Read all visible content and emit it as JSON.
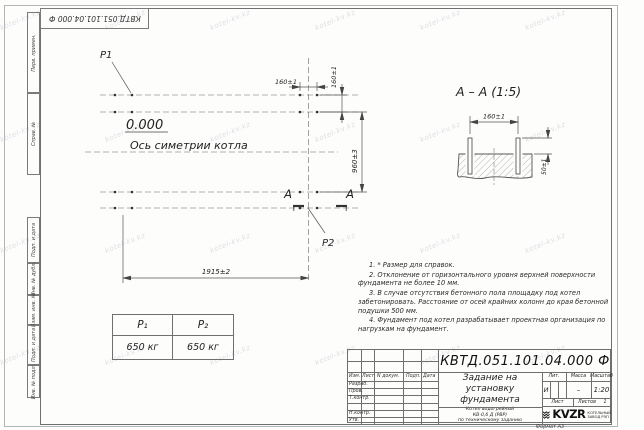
{
  "sheet": {
    "doc_number": "КВТД.051.101.04.000 Ф",
    "format_label": "Формат А3",
    "watermark": "kotel-kv.kz"
  },
  "margin": {
    "perv": "Перв. примен.",
    "sprav": "Справ. №",
    "podp1": "Подп. и дата",
    "inv_dubl": "Инв. № дубл.",
    "vzam": "Взам. инв. №",
    "podp2": "Подп. и дата",
    "inv_podl": "Инв. № подл."
  },
  "plan": {
    "p1": "P1",
    "p2": "P2",
    "level": "0.000",
    "axis": "Ось симетрии котла",
    "dim_bolt_x": "160±1",
    "dim_bolt_y": "160±1",
    "dim_height": "960±3",
    "dim_width": "1915±2",
    "section_letter": "А"
  },
  "section": {
    "title": "А – А (1:5)",
    "dim_spacing": "160±1",
    "dim_protrusion": "50±1"
  },
  "notes": [
    "1. * Размер для справок.",
    "2. Отклонение от горизонтального уровня верхней поверхности фундамента не более 10 мм.",
    "3. В случае отсутствия бетонного пола площадку под котел забетонировать. Расстояние от осей крайних колонн до края бетонной подушки 500 мм.",
    "4. Фундамент под котел разрабатывает проектная организация по нагрузкам на фундамент."
  ],
  "load_table": {
    "h1": "P₁",
    "h2": "P₂",
    "v1": "650 кг",
    "v2": "650 кг"
  },
  "title_block": {
    "cols": {
      "izm": "Изм.",
      "list": "Лист",
      "dokum": "N докум.",
      "podp": "Подп.",
      "data": "Дата"
    },
    "rows": {
      "razrab": "Разраб.",
      "prov": "Пров.",
      "tkontr": "Т.контр.",
      "nkontr": "Н.контр.",
      "utv": "Утв."
    },
    "title": "Задание на установку фундамента",
    "subtitle": [
      "Котел водогрейный",
      "КВ-0,6 Д (РВР)",
      "по техническому заданию"
    ],
    "lit_label": "Лит.",
    "lit_value": "И",
    "massa_label": "Масса",
    "massa_value": "–",
    "scale_label": "Масштаб",
    "scale_value": "1:20",
    "sheet_label": "Лист",
    "sheets_label": "Листов",
    "sheets_value": "1",
    "logo": "KVZR",
    "logo_caption": "КОТЕЛЬНЫЙ ЗАВОД РЭП"
  }
}
